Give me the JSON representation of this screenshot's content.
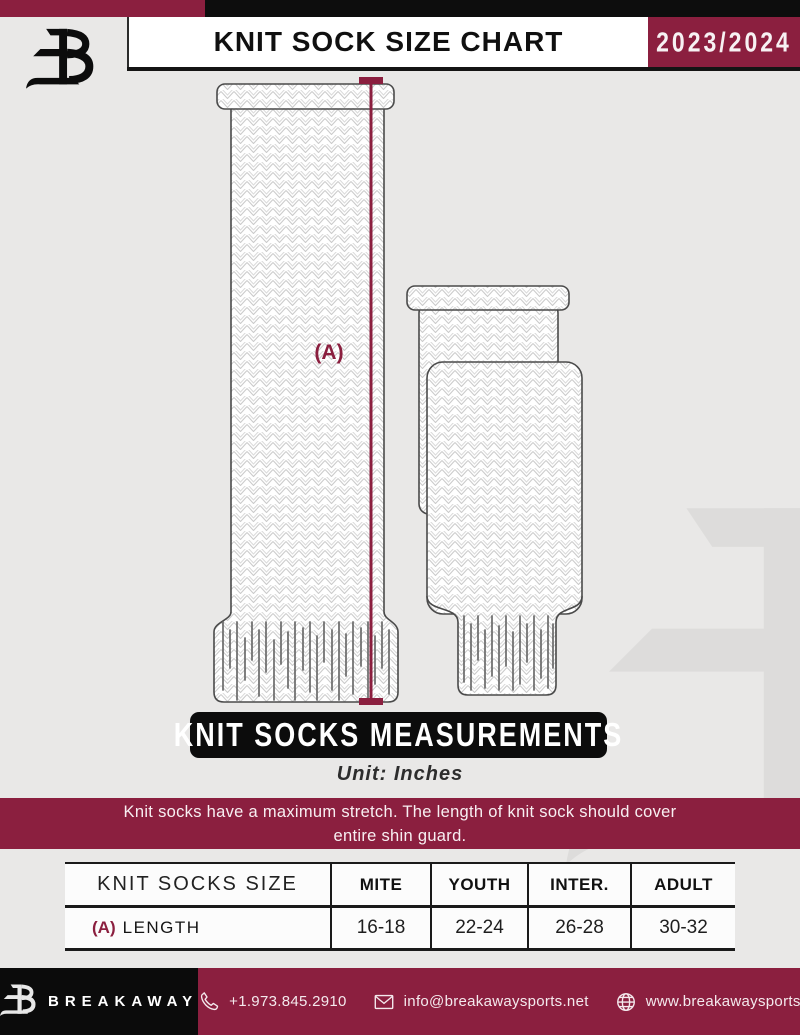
{
  "header": {
    "title": "KNIT SOCK SIZE CHART",
    "season": "2023/2024"
  },
  "diagram": {
    "measure_label": "(A)"
  },
  "measure_banner": {
    "title": "KNIT SOCKS MEASUREMENTS",
    "unit": "Unit: Inches"
  },
  "note": {
    "lines": [
      "Knit socks have a maximum stretch. The length of knit sock should cover",
      "entire shin guard."
    ]
  },
  "table": {
    "headers": [
      "KNIT SOCKS SIZE",
      "MITE",
      "YOUTH",
      "INTER.",
      "ADULT"
    ],
    "rows": [
      {
        "prefix": "(A)",
        "label": "LENGTH",
        "values": [
          "16-18",
          "22-24",
          "26-28",
          "30-32"
        ]
      }
    ]
  },
  "footer": {
    "brand": "BREAKAWAY",
    "phone": "+1.973.845.2910",
    "email": "info@breakawaysports.net",
    "website": "www.breakawaysports.net"
  },
  "colors": {
    "maroon": "#8B1F3F",
    "black": "#0D0D0D",
    "page_bg": "#E9E8E7",
    "sock_outline": "#4A4A4A",
    "knit_pattern": "#CBCBCB"
  }
}
